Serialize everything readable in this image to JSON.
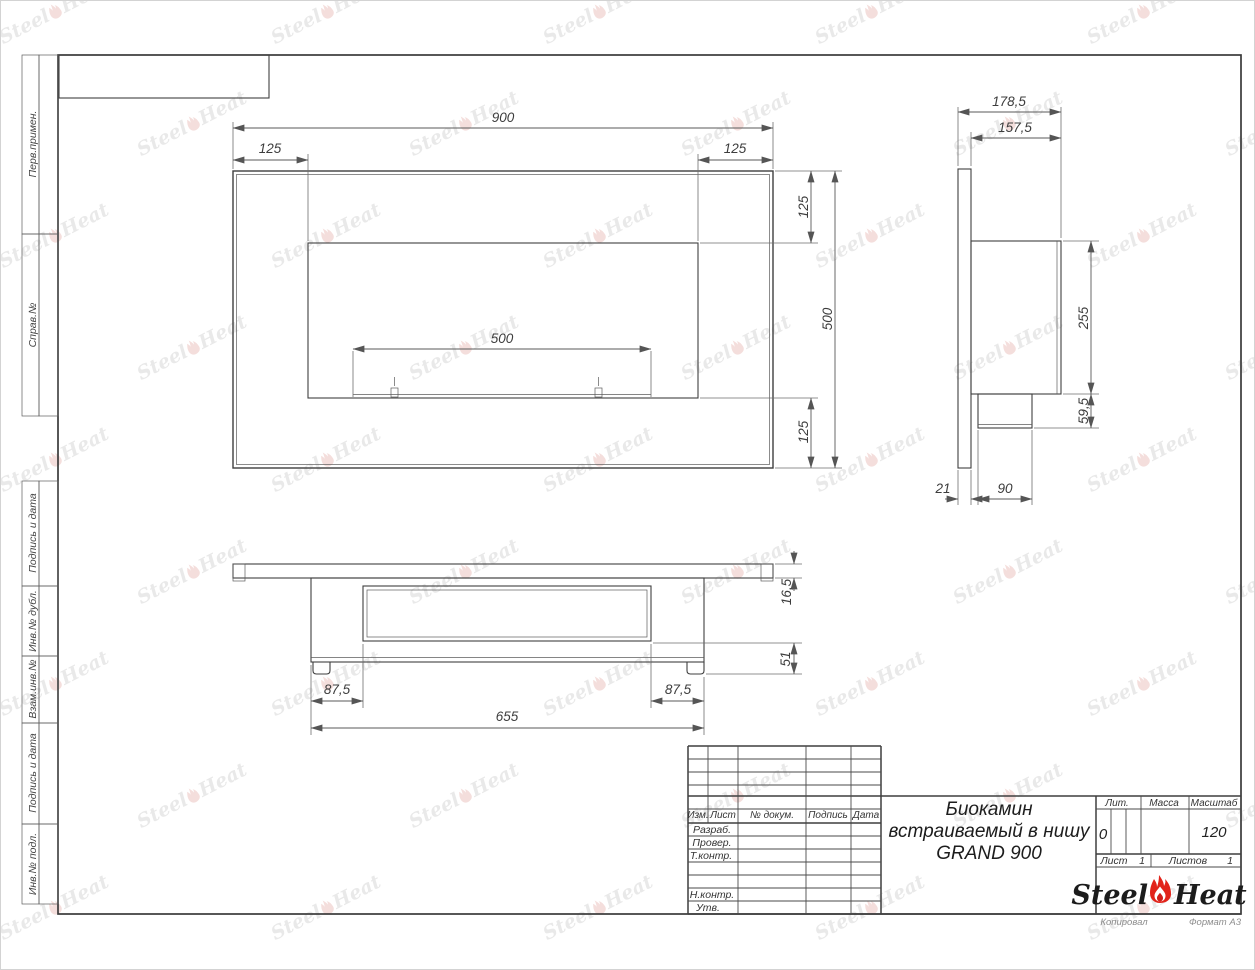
{
  "margin_labels": {
    "perv": "Перв.примен.",
    "sprav": "Справ.№",
    "podpis1": "Подпись и дата",
    "inv_dubl": "Инв.№ дубл.",
    "vzam": "Взам.инв.№",
    "podpis2": "Подпись и дата",
    "inv_podl": "Инв.№ подл."
  },
  "front_view": {
    "total_width": "900",
    "left_offset": "125",
    "right_offset": "125",
    "top_offset": "125",
    "total_height": "500",
    "bottom_offset": "125",
    "burner_width": "500"
  },
  "side_view": {
    "total_depth": "178,5",
    "body_depth": "157,5",
    "body_height": "255",
    "burner_box_height": "59,5",
    "panel_thickness": "21",
    "burner_box_depth": "90"
  },
  "bottom_view": {
    "panel_thickness": "16,5",
    "lower_height": "51",
    "left_inset": "87,5",
    "right_inset": "87,5",
    "body_width": "655"
  },
  "title_block": {
    "cols": {
      "izm": "Изм.",
      "list": "Лист",
      "doc": "№ докум.",
      "podpis": "Подпись",
      "data": "Дата"
    },
    "rows": {
      "razrab": "Разраб.",
      "prover": "Провер.",
      "tkontr": "Т.контр.",
      "nkontr": "Н.контр.",
      "utv": "Утв."
    },
    "title_line1": "Биокамин",
    "title_line2": "встраиваемый в нишу",
    "title_line3": "GRAND 900",
    "lit_label": "Лит.",
    "mass_label": "Масса",
    "scale_label": "Масштаб",
    "lit_value": "0",
    "scale_value": "120",
    "sheet_label": "Лист",
    "sheet_value": "1",
    "sheets_label": "Листов",
    "sheets_value": "1",
    "brand_part1": "Steel",
    "brand_part2": "Heat"
  },
  "footer": {
    "copied_by": "Копировал",
    "format": "Формат A3"
  },
  "watermark": {
    "part1": "Steel",
    "part2": "Heat"
  },
  "colors": {
    "line": "#3f3f3f",
    "flame_red": "#e2231a",
    "flame_inner": "#d01f1a",
    "watermark_text": "#d2d2d2",
    "watermark_flame": "#e9bcb9"
  }
}
